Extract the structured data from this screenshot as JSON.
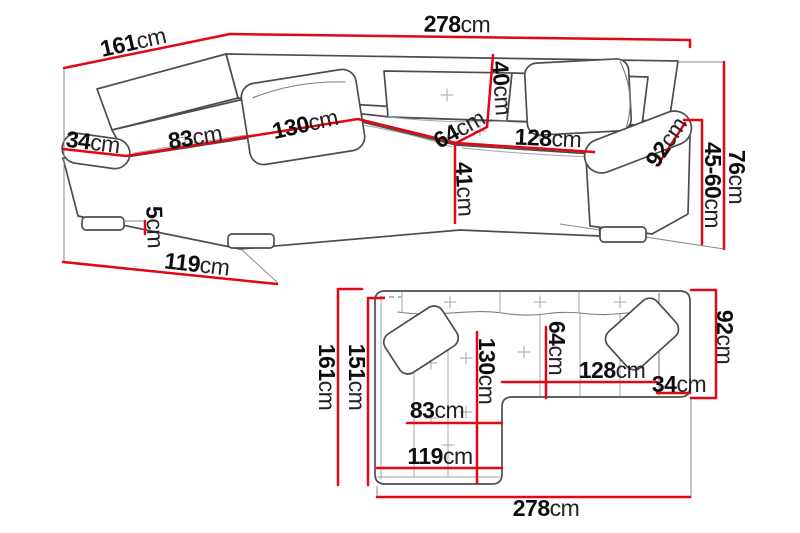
{
  "diagram": {
    "title": "corner-sofa-dimensions",
    "unit": "cm",
    "accent_color": "#e30613",
    "outline_color": "#4d4d4d"
  },
  "views": {
    "perspective": {
      "label": "perspective-view",
      "dims": [
        {
          "id": "total-width",
          "value": "278",
          "unit": "cm"
        },
        {
          "id": "side-depth",
          "value": "161",
          "unit": "cm"
        },
        {
          "id": "armrest-width",
          "value": "34",
          "unit": "cm"
        },
        {
          "id": "chaise-seat-width",
          "value": "83",
          "unit": "cm"
        },
        {
          "id": "chaise-seat-length",
          "value": "130",
          "unit": "cm"
        },
        {
          "id": "backrest-height",
          "value": "40",
          "unit": "cm"
        },
        {
          "id": "corner-seat-depth",
          "value": "64",
          "unit": "cm"
        },
        {
          "id": "seat-width",
          "value": "128",
          "unit": "cm"
        },
        {
          "id": "armrest-depth",
          "value": "92",
          "unit": "cm"
        },
        {
          "id": "seat-front-height",
          "value": "41",
          "unit": "cm"
        },
        {
          "id": "seat-height-range",
          "value": "45-60",
          "unit": "cm"
        },
        {
          "id": "total-height",
          "value": "76",
          "unit": "cm"
        },
        {
          "id": "leg-height",
          "value": "5",
          "unit": "cm"
        },
        {
          "id": "chaise-outer-length",
          "value": "119",
          "unit": "cm"
        }
      ]
    },
    "plan": {
      "label": "top-plan-view",
      "dims": [
        {
          "id": "total-depth",
          "value": "161",
          "unit": "cm"
        },
        {
          "id": "inner-depth",
          "value": "151",
          "unit": "cm"
        },
        {
          "id": "chaise-seat-length",
          "value": "130",
          "unit": "cm"
        },
        {
          "id": "corner-seat-depth",
          "value": "64",
          "unit": "cm"
        },
        {
          "id": "seat-width",
          "value": "128",
          "unit": "cm"
        },
        {
          "id": "armrest-width",
          "value": "34",
          "unit": "cm"
        },
        {
          "id": "chaise-seat-width",
          "value": "83",
          "unit": "cm"
        },
        {
          "id": "chaise-outer-length",
          "value": "119",
          "unit": "cm"
        },
        {
          "id": "armrest-depth",
          "value": "92",
          "unit": "cm"
        },
        {
          "id": "total-width",
          "value": "278",
          "unit": "cm"
        }
      ]
    }
  }
}
